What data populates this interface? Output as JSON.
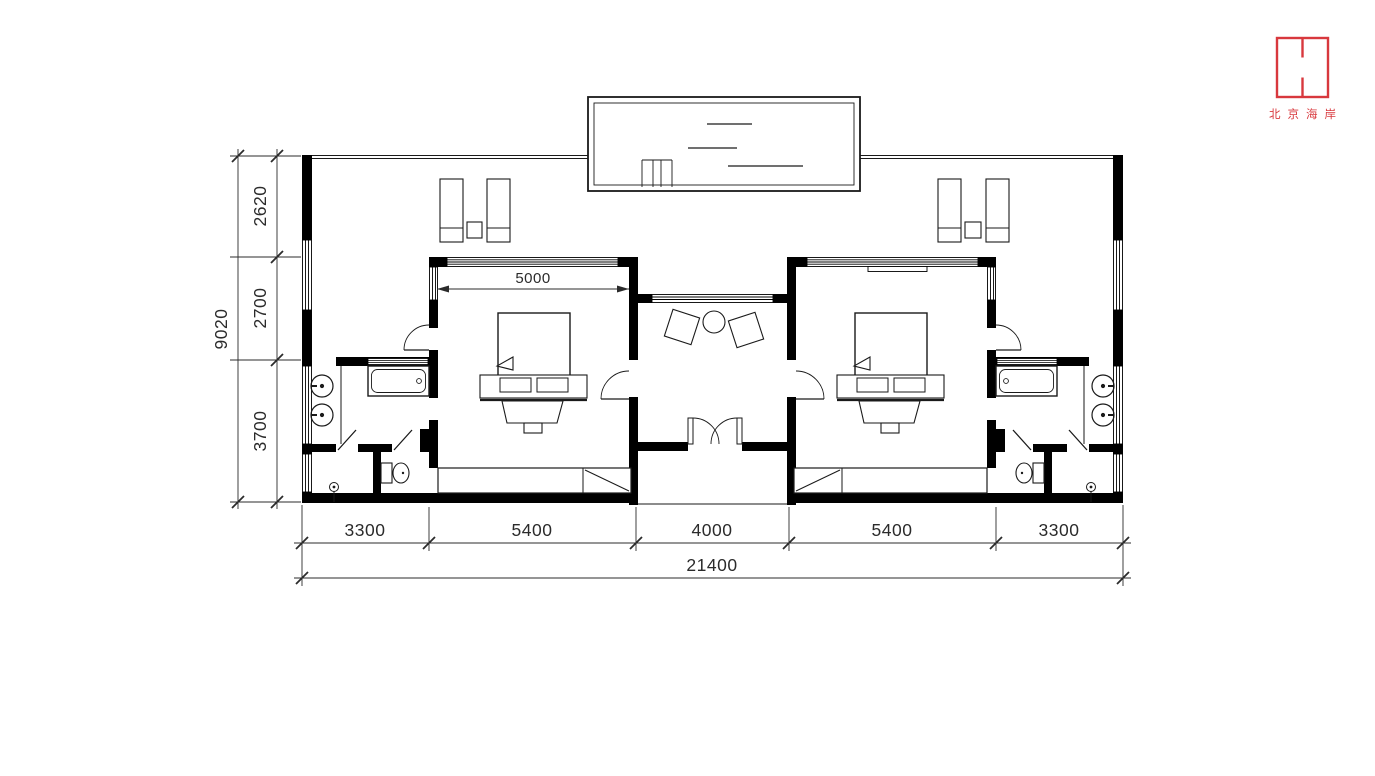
{
  "colors": {
    "accent_red": "#d8383d",
    "wall_black": "#000000",
    "line_dark": "#1a1a1a",
    "background": "#ffffff"
  },
  "logo": {
    "brand_text": "北京海岸"
  },
  "dimensions": {
    "bottom_chain": [
      "3300",
      "5400",
      "4000",
      "5400",
      "3300"
    ],
    "bottom_total": "21400",
    "left_chain": [
      "2620",
      "2700",
      "3700"
    ],
    "left_total": "9020",
    "bedroom_width": "5000"
  }
}
